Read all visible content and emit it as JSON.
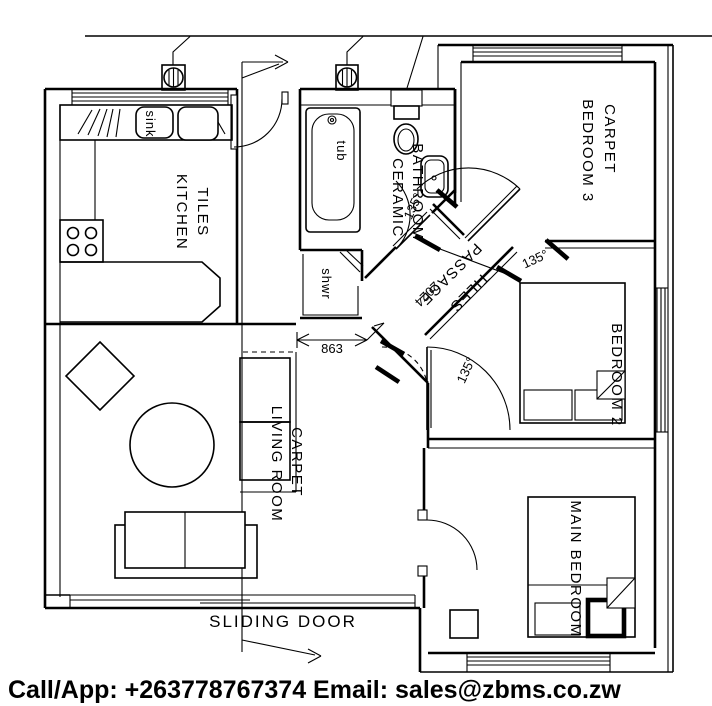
{
  "banner": {
    "text": "Call/App: +263778767374  Email: sales@zbms.co.zw",
    "color": "#E8932C"
  },
  "rooms": {
    "kitchen": {
      "name": "KITCHEN",
      "finish": "TILES"
    },
    "bathroom": {
      "name": "BATHROOM",
      "finish": "CERAMIC"
    },
    "bedroom3": {
      "name": "BEDROOM 3",
      "finish": "CARPET"
    },
    "bedroom2": {
      "name": "BEDROOM 2"
    },
    "main_bedroom": {
      "name": "MAIN BEDROOM"
    },
    "living_room": {
      "name": "LIVING ROOM",
      "finish": "CARPET"
    },
    "passage": {
      "name": "PASSAGE",
      "finish": "TILES"
    }
  },
  "fixtures": {
    "sink": "sink",
    "tub": "tub",
    "shower": "shwr"
  },
  "dimensions": {
    "opening_width": "863",
    "passage_length": "2024"
  },
  "angles": {
    "bathroom_door": "135°",
    "bedroom3_door": "135°",
    "bedroom2_door": "135°"
  },
  "annotations": {
    "sliding_door": "SLIDING DOOR"
  }
}
